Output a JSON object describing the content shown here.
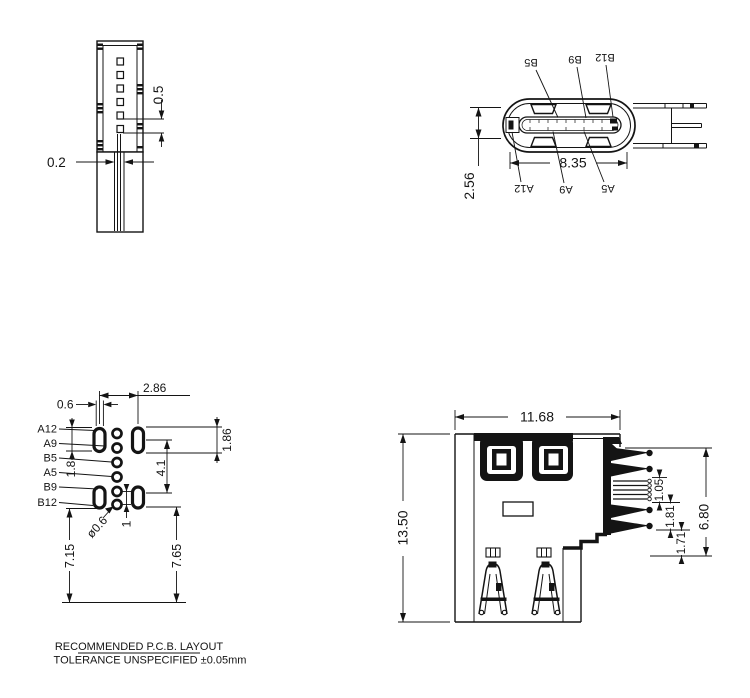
{
  "sheet": {
    "background": "#ffffff",
    "line_color": "#141414",
    "notes": {
      "line1": "RECOMMENDED  P.C.B.  LAYOUT",
      "line2": "TOLERANCE UNSPECIFIED ±0.05mm"
    }
  },
  "side_view": {
    "dim_pad_pitch": "0.5",
    "dim_lead_width": "0.2"
  },
  "front_view": {
    "dim_opening_width": "8.35",
    "dim_opening_height": "2.56",
    "labels": {
      "b5": "B5",
      "b9": "B9",
      "b12": "B12",
      "a12": "A12",
      "a9": "A9",
      "a5": "A5"
    }
  },
  "pcb_layout": {
    "labels": {
      "a12": "A12",
      "a9": "A9",
      "b5": "B5",
      "a5": "A5",
      "b9": "B9",
      "b12": "B12"
    },
    "dim_slot_width": "0.6",
    "dim_column_pitch": "2.86",
    "dim_pad_length_right": "1.86",
    "dim_row_pitch": "4.1",
    "dim_pad_length_left": "1.8",
    "dim_hole_dia": "ø0.6",
    "dim_hole_pitch": "1",
    "dim_edge_left": "7.15",
    "dim_edge_right": "7.65"
  },
  "rear_view": {
    "dim_width": "11.68",
    "dim_height": "13.50",
    "dim_contact_zone": "6.80",
    "dim_seg_a": "1.05",
    "dim_seg_b": "1.81",
    "dim_seg_c": "1.71"
  }
}
